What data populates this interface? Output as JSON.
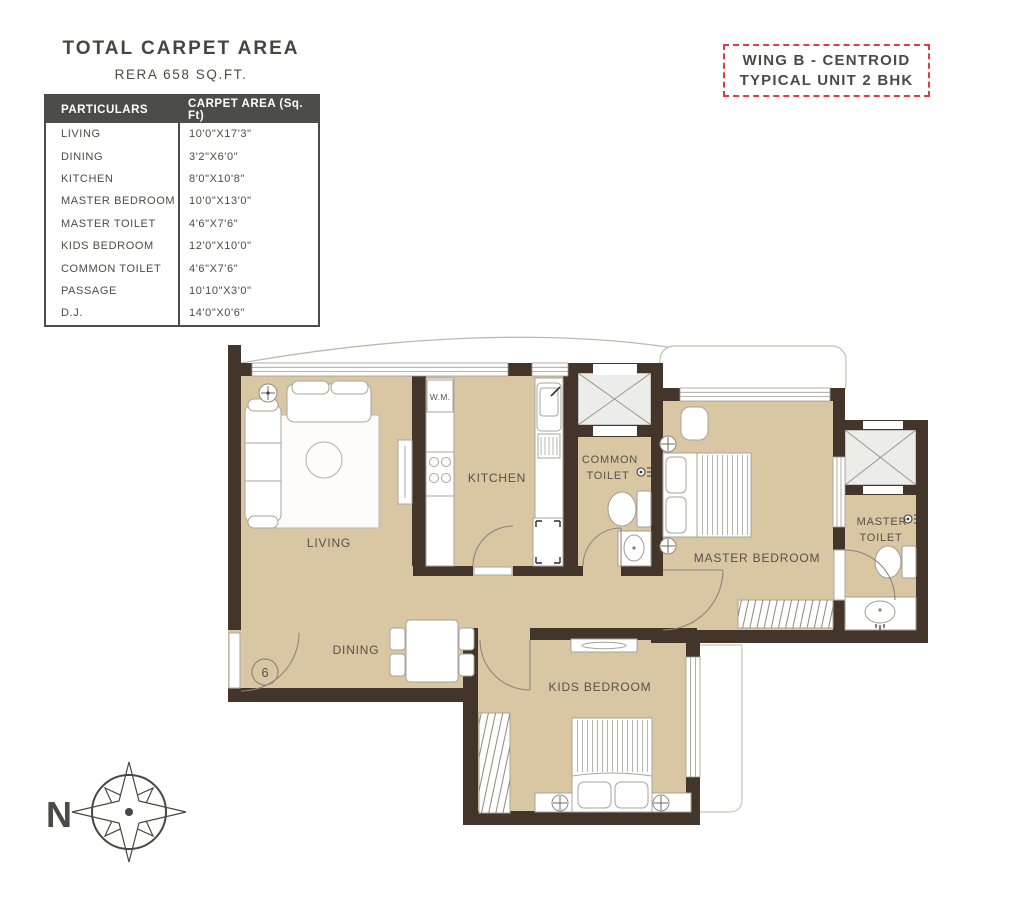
{
  "title_block": {
    "title": "TOTAL CARPET AREA",
    "subtitle": "RERA 658 SQ.FT."
  },
  "carpet_table": {
    "col_particulars": "PARTICULARS",
    "col_area": "CARPET AREA (Sq. Ft)",
    "rows": [
      {
        "room": "LIVING",
        "area": "10'0\"X17'3\""
      },
      {
        "room": "DINING",
        "area": "3'2\"X6'0\""
      },
      {
        "room": "KITCHEN",
        "area": "8'0\"X10'8\""
      },
      {
        "room": "MASTER BEDROOM",
        "area": "10'0\"X13'0\""
      },
      {
        "room": "MASTER TOILET",
        "area": "4'6\"X7'6\""
      },
      {
        "room": "KIDS BEDROOM",
        "area": "12'0\"X10'0\""
      },
      {
        "room": "COMMON TOILET",
        "area": "4'6\"X7'6\""
      },
      {
        "room": "PASSAGE",
        "area": "10'10\"X3'0\""
      },
      {
        "room": "D.J.",
        "area": "14'0\"X0'6\""
      }
    ]
  },
  "unit_badge": {
    "line1": "WING B - CENTROID",
    "line2": "TYPICAL UNIT 2 BHK"
  },
  "floor_plan": {
    "labels": {
      "living": "LIVING",
      "dining": "DINING",
      "kitchen": "KITCHEN",
      "wm": "W.M.",
      "common_toilet_line1": "COMMON",
      "common_toilet_line2": "TOILET",
      "master_bedroom": "MASTER BEDROOM",
      "master_toilet_line1": "MASTER",
      "master_toilet_line2": "TOILET",
      "kids_bedroom": "KIDS BEDROOM",
      "unit_number": "6"
    },
    "compass": {
      "north": "N"
    }
  },
  "colors": {
    "wall": "#44352a",
    "floor": "#d9c6a2",
    "accent_red": "#e23b41",
    "table_header": "#4c4c4a",
    "label_text": "#57524a"
  }
}
